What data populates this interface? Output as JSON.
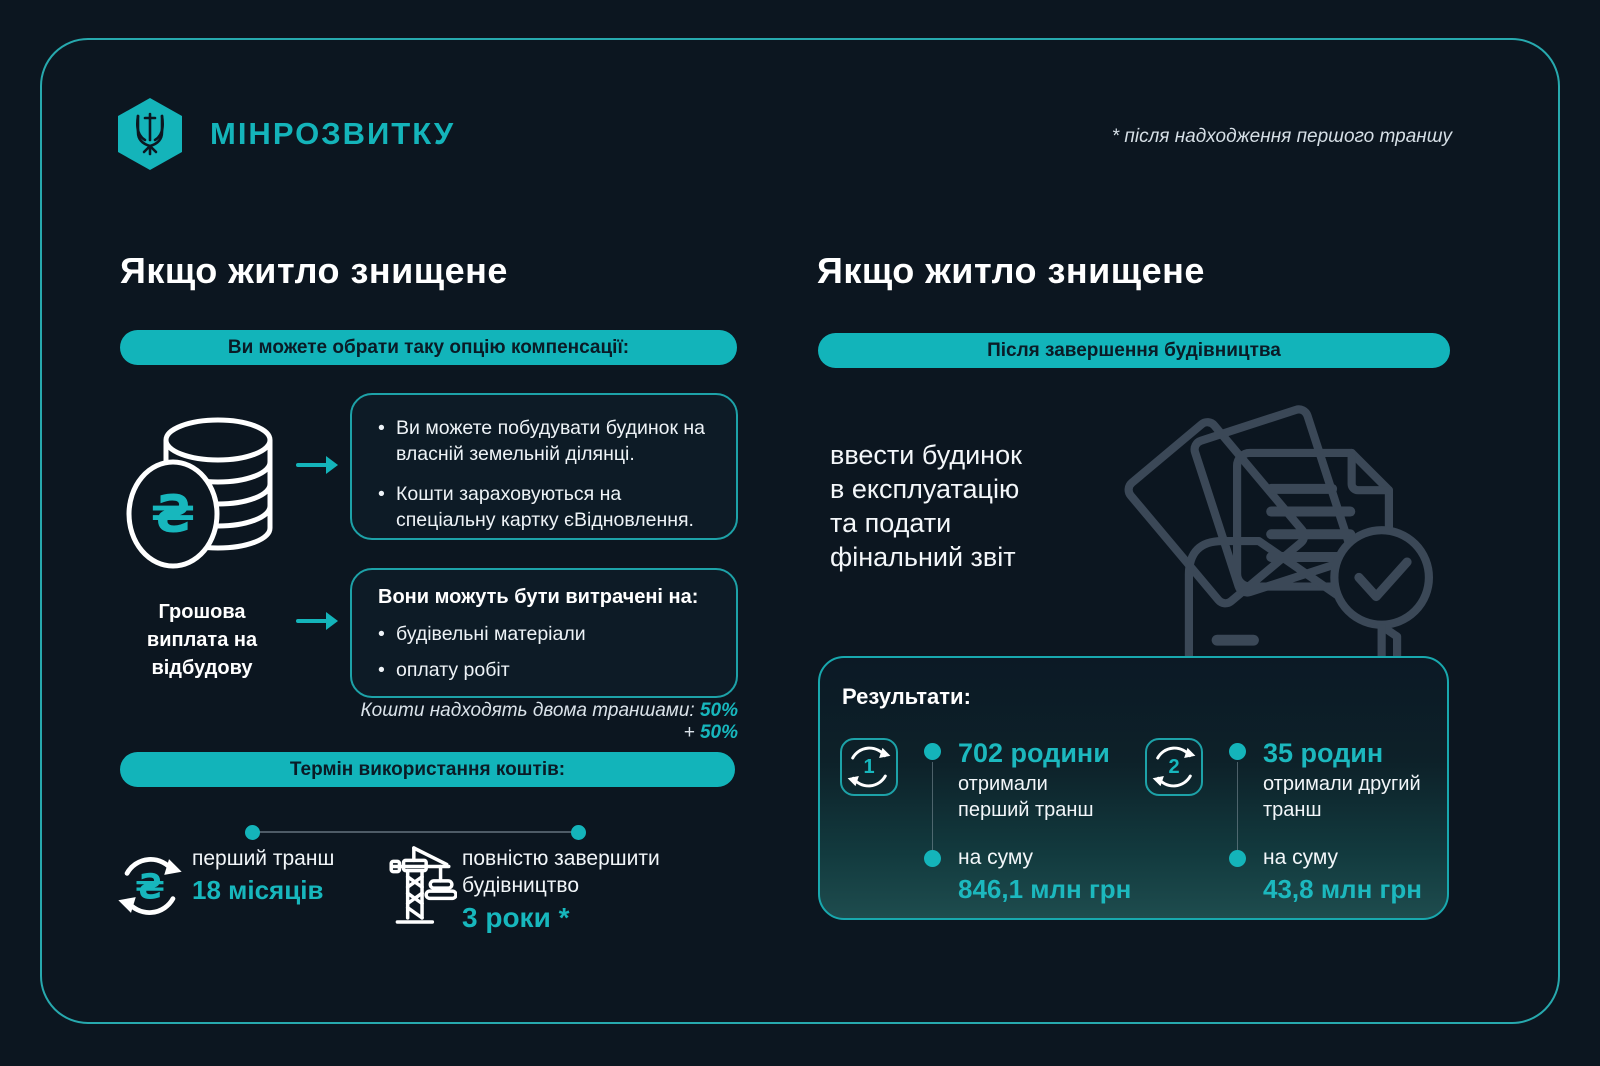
{
  "colors": {
    "background": "#0c1620",
    "accent_teal": "#14b4ba",
    "frame_border": "#27a9ae",
    "illustration_gray": "#3b4857"
  },
  "icons": {
    "hryvnia_symbol": "₴"
  },
  "header": {
    "brand": "МІНРОЗВИТКУ",
    "footnote": "* після надходження першого траншу"
  },
  "left": {
    "title": "Якщо житло знищене",
    "pill_options": "Ви можете обрати таку опцію компенсації:",
    "option_box_bullets": [
      "Ви можете побудувати будинок на власній земельній ділянці.",
      "Кошти зараховуються на спеціальну картку єВідновлення."
    ],
    "payment_label": "Грошова виплата на відбудову",
    "spend_box_title": "Вони можуть бути витрачені на:",
    "spend_box_bullets": [
      "будівельні матеріали",
      "оплату робіт"
    ],
    "tranches_prefix": "Кошти надходять двома траншами:",
    "tranches_value1": "50%",
    "tranches_plus": "+",
    "tranches_value2": "50%",
    "pill_term": "Термін використання коштів:",
    "timeline_items": [
      {
        "label": "перший транш",
        "value": "18 місяців"
      },
      {
        "label": "повністю завершити будівництво",
        "value": "3 роки *"
      }
    ]
  },
  "right": {
    "title": "Якщо житло знищене",
    "pill": "Після завершення будівництва",
    "body_lines": [
      "ввести будинок",
      "в експлуатацію",
      "та подати",
      "фінальний звіт"
    ],
    "results": {
      "title": "Результати:",
      "items": [
        {
          "number": "1",
          "headline": "702 родини",
          "sub_lines": [
            "отримали",
            "перший транш"
          ],
          "amount_label": "на суму",
          "amount": "846,1 млн грн"
        },
        {
          "number": "2",
          "headline": "35 родин",
          "sub_lines": [
            "отримали другий",
            "транш"
          ],
          "amount_label": "на суму",
          "amount": "43,8 млн грн"
        }
      ]
    }
  }
}
